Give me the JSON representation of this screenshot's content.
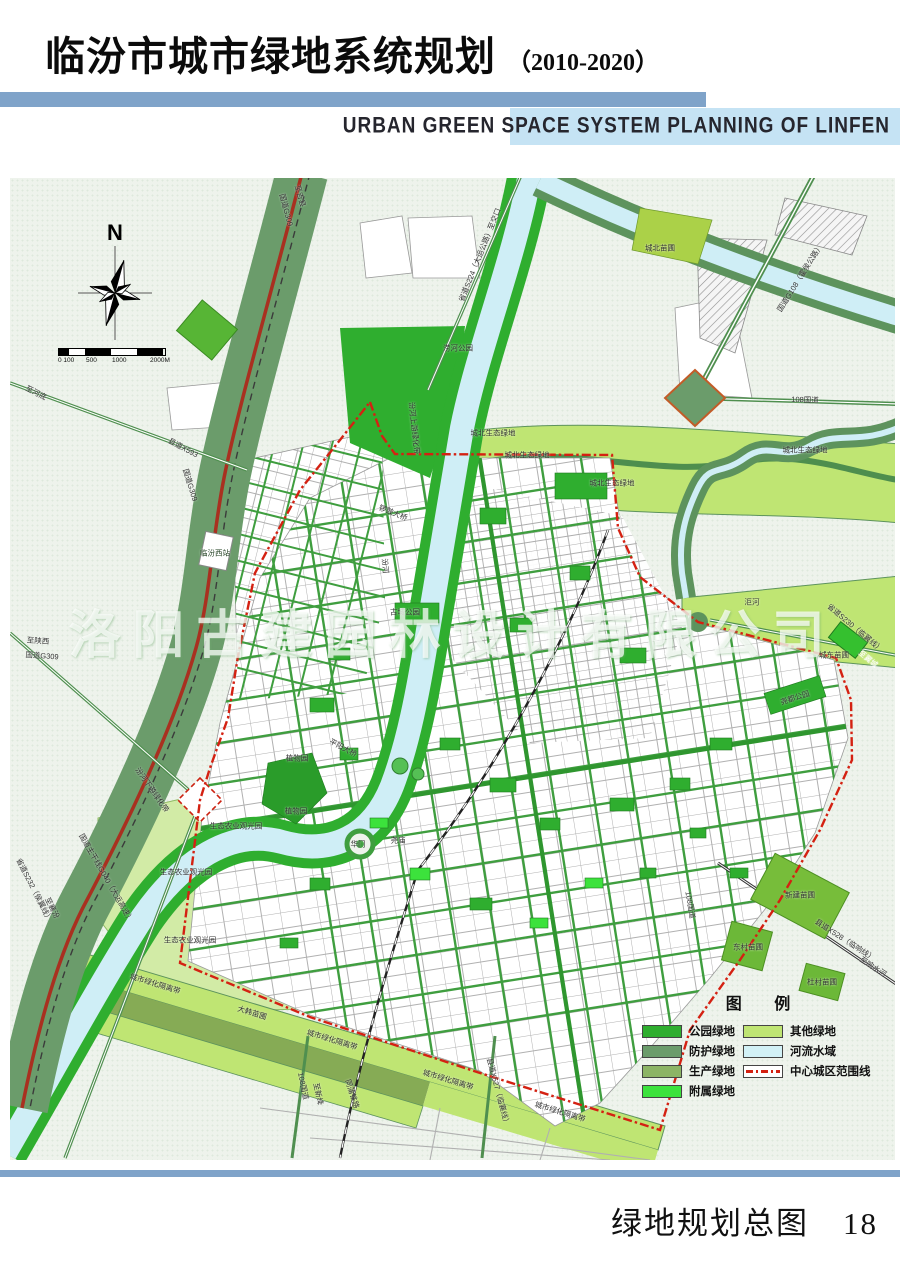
{
  "header": {
    "title_cn": "临汾市城市绿地系统规划",
    "title_year": "（2010-2020）",
    "subtitle_en": "URBAN GREEN SPACE SYSTEM PLANNING OF LINFEN"
  },
  "footer": {
    "caption": "绿地规划总图",
    "page_number": "18"
  },
  "watermark": "洛阳古建园林设计有限公司",
  "colors": {
    "header_rule_blue": "#7fa3c9",
    "subtitle_bar_blue": "#c5e3f4",
    "park_green": "#2fae2f",
    "protection_green": "#6b9c6b",
    "production_green": "#8cb465",
    "attached_green": "#3ce23c",
    "other_green": "#bfe573",
    "river_blue": "#cfeef6",
    "boundary_red": "#d42112",
    "road_red": "#a93020",
    "map_background": "#eef3ec"
  },
  "map": {
    "compass_label": "N",
    "scale_bar": {
      "ticks": [
        {
          "text": "0 100",
          "x": 0
        },
        {
          "text": "500",
          "x": 28
        },
        {
          "text": "1000",
          "x": 54
        },
        {
          "text": "2000M",
          "x": 92
        }
      ]
    },
    "legend": {
      "title": "图  例",
      "items": [
        {
          "label": "公园绿地",
          "color": "#2fae2f",
          "type": "swatch",
          "col": 0
        },
        {
          "label": "防护绿地",
          "color": "#6b9c6b",
          "type": "swatch",
          "col": 0
        },
        {
          "label": "生产绿地",
          "color": "#8cb465",
          "type": "swatch",
          "col": 0
        },
        {
          "label": "附属绿地",
          "color": "#3ce23c",
          "type": "swatch",
          "col": 0
        },
        {
          "label": "其他绿地",
          "color": "#bfe573",
          "type": "swatch",
          "col": 1
        },
        {
          "label": "河流水域",
          "color": "#d2f1f6",
          "type": "swatch",
          "col": 1
        },
        {
          "label": "中心城区范围线",
          "color": "#d42112",
          "type": "boundary",
          "col": 1
        }
      ]
    },
    "labels": [
      {
        "text": "至吉县",
        "x": 290,
        "y": 18,
        "rot": 75
      },
      {
        "text": "国道G309",
        "x": 276,
        "y": 32,
        "rot": 75
      },
      {
        "text": "省道S224（大运公路）至交口",
        "x": 470,
        "y": 77,
        "rot": -68
      },
      {
        "text": "涝河公园",
        "x": 448,
        "y": 170,
        "rot": 0
      },
      {
        "text": "城北苗圃",
        "x": 650,
        "y": 70,
        "rot": 0
      },
      {
        "text": "国道G108（霍侯公路）",
        "x": 790,
        "y": 100,
        "rot": -58
      },
      {
        "text": "108国道",
        "x": 795,
        "y": 222,
        "rot": 2
      },
      {
        "text": "至河底",
        "x": 26,
        "y": 215,
        "rot": 27
      },
      {
        "text": "县道X593",
        "x": 173,
        "y": 270,
        "rot": 28
      },
      {
        "text": "国道G309",
        "x": 180,
        "y": 307,
        "rot": 73
      },
      {
        "text": "临汾西站",
        "x": 205,
        "y": 375,
        "rot": 0,
        "fg": "#1a3a1a"
      },
      {
        "text": "汾河上游绿化带",
        "x": 404,
        "y": 250,
        "rot": 84
      },
      {
        "text": "城北生态绿地",
        "x": 483,
        "y": 255,
        "rot": 0
      },
      {
        "text": "城北生态绿地",
        "x": 517,
        "y": 277,
        "rot": 0
      },
      {
        "text": "城北生态绿地",
        "x": 602,
        "y": 305,
        "rot": 0
      },
      {
        "text": "城北生态绿地",
        "x": 795,
        "y": 272,
        "rot": 0
      },
      {
        "text": "洰河",
        "x": 742,
        "y": 424,
        "rot": 0
      },
      {
        "text": "省道S230（临翼线）",
        "x": 845,
        "y": 450,
        "rot": 40
      },
      {
        "text": "城东苗圃",
        "x": 824,
        "y": 477,
        "rot": 0
      },
      {
        "text": "至翼城",
        "x": 858,
        "y": 481,
        "rot": 40,
        "fg": "#ffffff"
      },
      {
        "text": "尧都公园",
        "x": 785,
        "y": 520,
        "rot": -18
      },
      {
        "text": "汾河",
        "x": 375,
        "y": 388,
        "rot": 84
      },
      {
        "text": "古城公园",
        "x": 395,
        "y": 434,
        "rot": 0
      },
      {
        "text": "锣鼓大桥",
        "x": 383,
        "y": 335,
        "rot": 22
      },
      {
        "text": "至陕西",
        "x": 28,
        "y": 463,
        "rot": 4
      },
      {
        "text": "国道G309",
        "x": 32,
        "y": 478,
        "rot": 4
      },
      {
        "text": "平阳大桥",
        "x": 333,
        "y": 570,
        "rot": 28
      },
      {
        "text": "植物园",
        "x": 287,
        "y": 580,
        "rot": 0
      },
      {
        "text": "植物园",
        "x": 286,
        "y": 633,
        "rot": 0
      },
      {
        "text": "生态农业观光园",
        "x": 226,
        "y": 648,
        "rot": 0
      },
      {
        "text": "生态农业观光园",
        "x": 176,
        "y": 694,
        "rot": 0
      },
      {
        "text": "生态农业观光园",
        "x": 180,
        "y": 762,
        "rot": 0
      },
      {
        "text": "华门",
        "x": 348,
        "y": 666,
        "rot": 0
      },
      {
        "text": "尧庙",
        "x": 388,
        "y": 662,
        "rot": 0
      },
      {
        "text": "汾河下游绿化带",
        "x": 142,
        "y": 612,
        "rot": 55
      },
      {
        "text": "省道S232（侯翼线）",
        "x": 24,
        "y": 712,
        "rot": 63
      },
      {
        "text": "至襄汾",
        "x": 42,
        "y": 730,
        "rot": 63
      },
      {
        "text": "国道主干线G040（大运高速）",
        "x": 96,
        "y": 700,
        "rot": 60
      },
      {
        "text": "城市绿化隔离带",
        "x": 145,
        "y": 806,
        "rot": 17
      },
      {
        "text": "大韩苗圃",
        "x": 242,
        "y": 835,
        "rot": 17
      },
      {
        "text": "城市绿化隔离带",
        "x": 322,
        "y": 862,
        "rot": 17
      },
      {
        "text": "城市绿化隔离带",
        "x": 438,
        "y": 902,
        "rot": 17
      },
      {
        "text": "城市绿化隔离带",
        "x": 550,
        "y": 934,
        "rot": 17
      },
      {
        "text": "108国道",
        "x": 293,
        "y": 908,
        "rot": 78
      },
      {
        "text": "至新绛",
        "x": 308,
        "y": 916,
        "rot": 78
      },
      {
        "text": "同蒲铁路",
        "x": 342,
        "y": 916,
        "rot": 72
      },
      {
        "text": "县道X527（临襄线）",
        "x": 488,
        "y": 914,
        "rot": 75
      },
      {
        "text": "108国道",
        "x": 680,
        "y": 727,
        "rot": 80
      },
      {
        "text": "新建苗圃",
        "x": 790,
        "y": 717,
        "rot": 0
      },
      {
        "text": "县道X528（临响线）",
        "x": 835,
        "y": 762,
        "rot": 33
      },
      {
        "text": "至响水河",
        "x": 863,
        "y": 789,
        "rot": 33
      },
      {
        "text": "东村苗圃",
        "x": 738,
        "y": 769,
        "rot": 0
      },
      {
        "text": "杜村苗圃",
        "x": 812,
        "y": 804,
        "rot": 0
      }
    ]
  }
}
